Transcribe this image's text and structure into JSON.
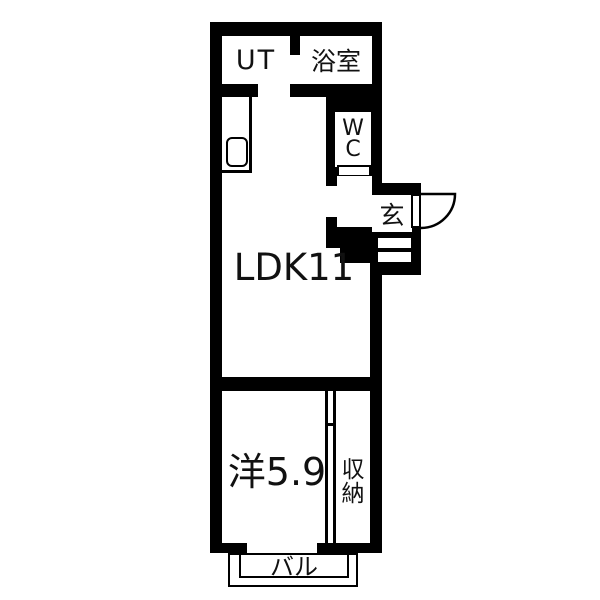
{
  "plan": {
    "background": "#ffffff",
    "wall_color": "#000000",
    "line_color": "#000000",
    "rooms": {
      "ut": "UT",
      "bath": "浴室",
      "wc": "WC",
      "entrance": "玄",
      "ldk": "LDK11",
      "western": "洋5.9",
      "closet": "収納",
      "balcony": "バル"
    },
    "fixtures": {
      "sink": "kitchen-sink-icon",
      "entry_door": "door-swing-icon"
    }
  }
}
